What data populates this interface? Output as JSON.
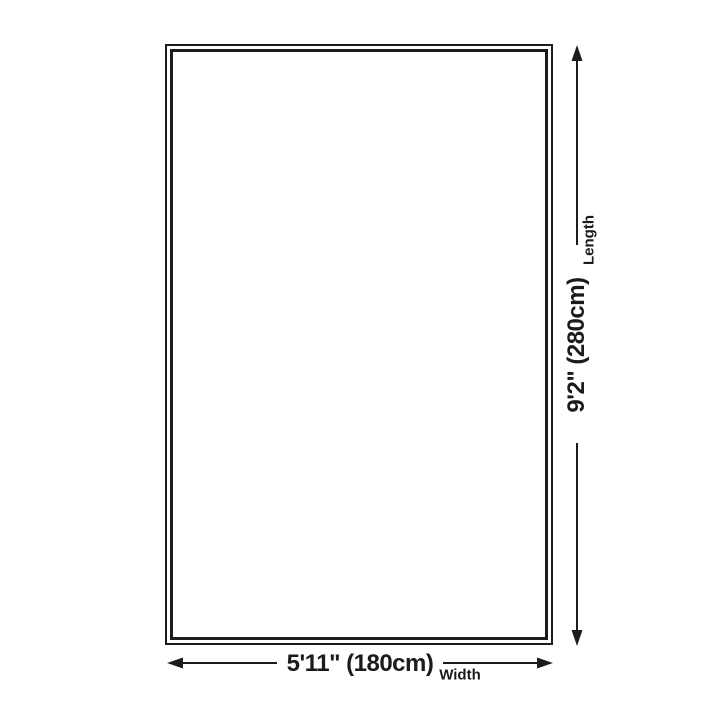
{
  "dimensions": {
    "length": {
      "value": "9'2\" (280cm)",
      "label": "Length"
    },
    "width": {
      "value": "5'11\" (180cm)",
      "label": "Width"
    }
  },
  "colors": {
    "background": "#ffffff",
    "line": "#1c1c1c",
    "text": "#1b1b1b"
  }
}
